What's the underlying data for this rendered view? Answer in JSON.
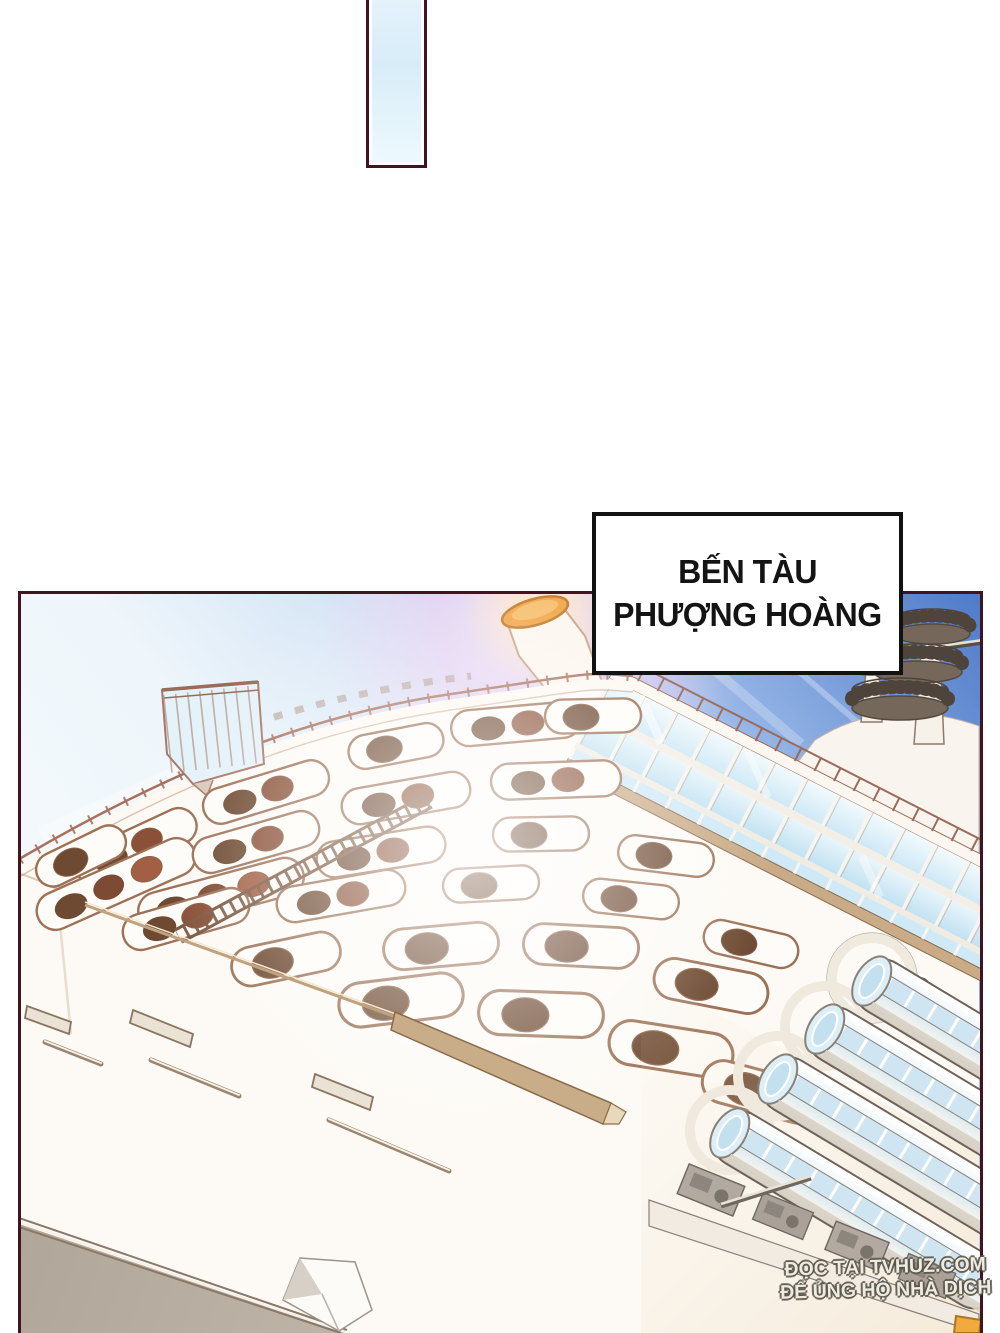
{
  "caption_box": {
    "line1": "BẾN TÀU",
    "line2": "PHƯỢNG HOÀNG"
  },
  "watermark": {
    "line1": "ĐỌC TẠI TVHUZ.COM",
    "line2": "ĐỂ ỦNG HỘ NHÀ DỊCH"
  },
  "colors": {
    "page_background": "#ffffff",
    "panel_border": "#41141f",
    "caption_border": "#121212",
    "caption_text": "#141414",
    "sky_deep_blue": "#4f7bc9",
    "sky_pale": "#eef6fb",
    "sky_pink_glow": "#f3d3ef",
    "hull_white": "#fdfaf5",
    "porthole_brown": "#6e4a32",
    "outline_brown": "#9c7156",
    "funnel_orange": "#f2a445",
    "glass_blue": "#d8eef8",
    "deck_band_tan": "#c9ab87",
    "lower_hull_gray": "#b6ac9f",
    "corner_orange": "#f2a93e"
  }
}
